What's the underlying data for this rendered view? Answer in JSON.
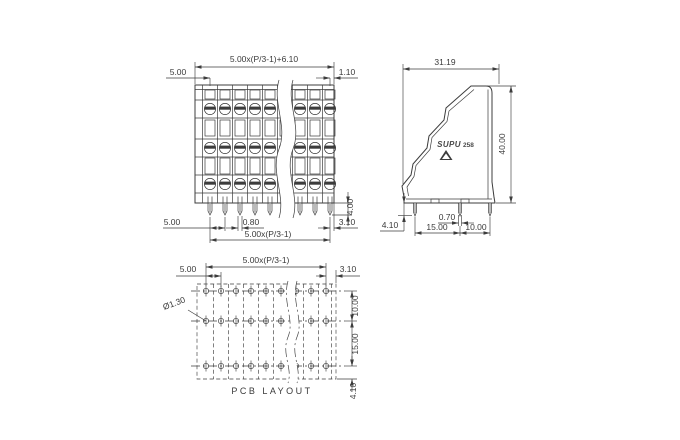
{
  "meta": {
    "drawing_type": "terminal-block-technical-drawing",
    "background": "#ffffff",
    "line_color": "#3c3c3c",
    "text_color": "#3a3a3a"
  },
  "front_view": {
    "dim_overall_width": "5.00x(P/3-1)+6.10",
    "dim_left_margin": "5.00",
    "dim_right_margin": "1.10",
    "dim_pin_pitch": "5.00",
    "dim_pin_width": "0.80",
    "dim_last_pin_to_edge": "3.10",
    "dim_pin_span": "5.00x(P/3-1)",
    "dim_pin_length": "4.00"
  },
  "side_view": {
    "dim_depth": "31.19",
    "dim_height": "40.00",
    "dim_pin_width": "0.70",
    "dim_pin_spacing_a": "15.00",
    "dim_pin_spacing_b": "10.00",
    "dim_pin_length": "4.10",
    "brand": "SUPU",
    "model": "258"
  },
  "pcb_layout": {
    "title": "PCB LAYOUT",
    "dim_hole_span": "5.00x(P/3-1)",
    "dim_hole_pitch": "5.00",
    "dim_right_margin": "3.10",
    "dim_hole_diameter": "Ø1.30",
    "dim_row_gap_top": "10.00",
    "dim_row_gap_bottom": "15.00",
    "dim_bottom_margin": "4.10"
  }
}
